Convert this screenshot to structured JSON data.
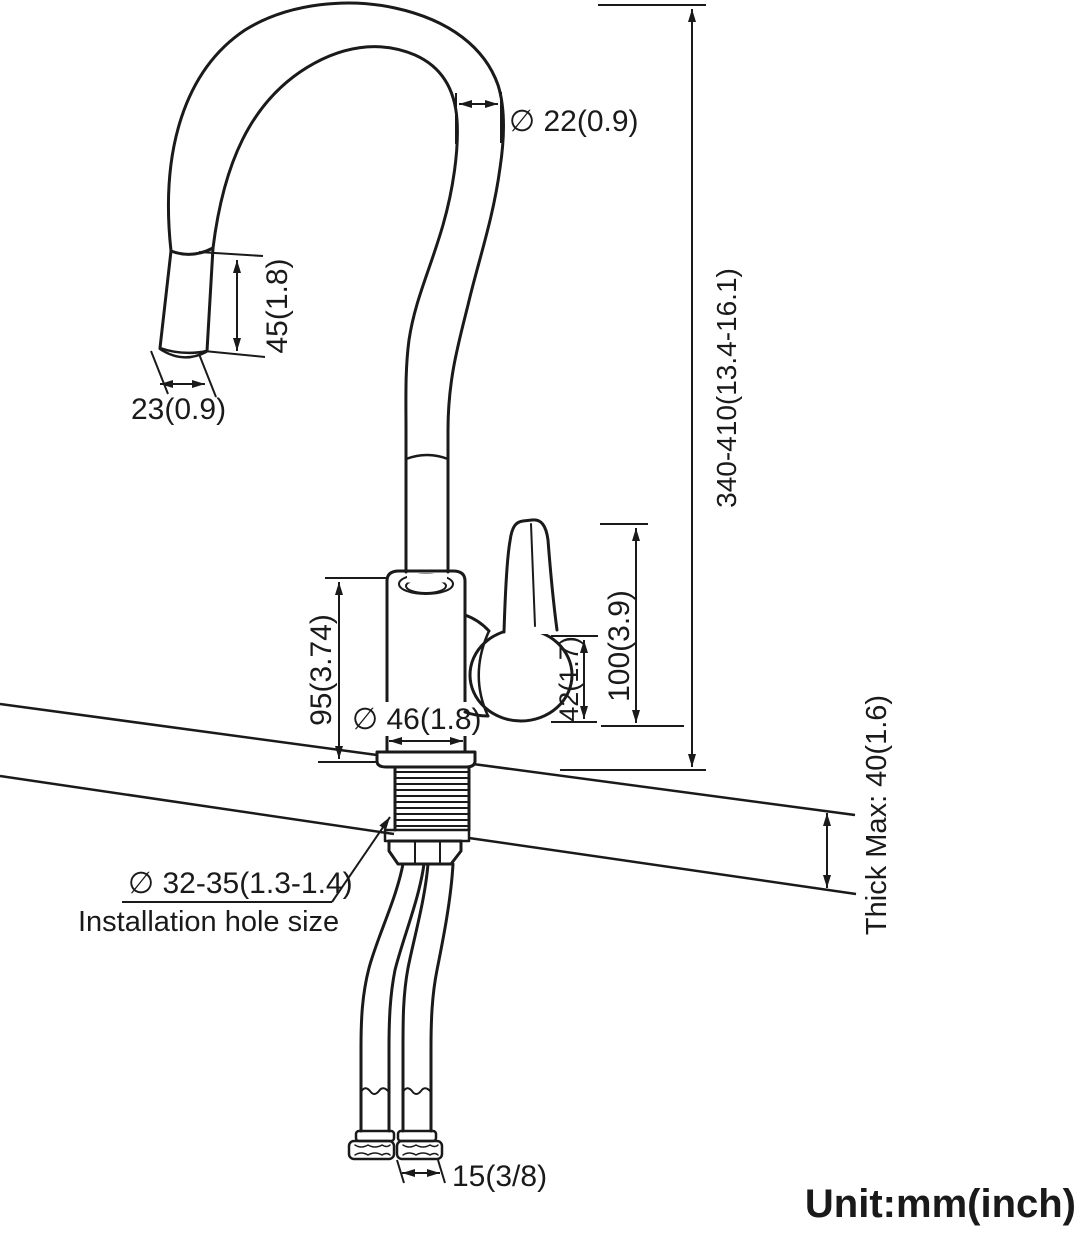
{
  "drawing": {
    "kind": "faucet-installation-dimension-diagram",
    "unit_note": "Unit:mm(inch)",
    "colors": {
      "line": "#1a1a1a",
      "background": "#ffffff"
    },
    "dims": {
      "spout_diameter": "∅ 22(0.9)",
      "spray_head_length": "45(1.8)",
      "spray_head_width": "23(0.9)",
      "overall_height": "340-410(13.4-16.1)",
      "body_height": "95(3.74)",
      "base_diameter": "∅ 46(1.8)",
      "handle_height": "100(3.9)",
      "handle_lever": "42(1.7)",
      "install_hole": "∅ 32-35(1.3-1.4)",
      "install_hole_note": "Installation hole size",
      "deck_thickness": "Thick Max: 40(1.6)",
      "supply_connector": "15(3/8)"
    }
  }
}
